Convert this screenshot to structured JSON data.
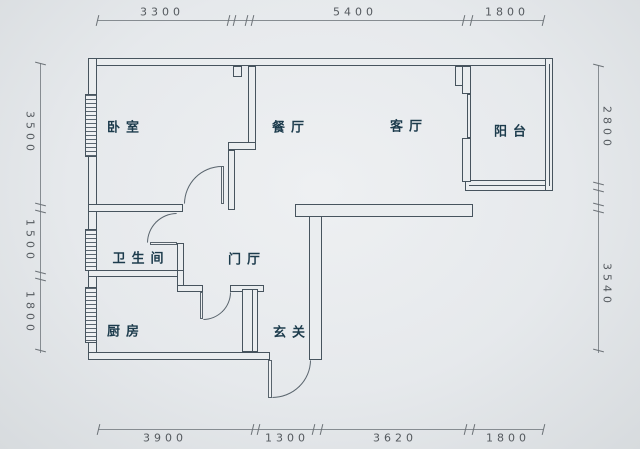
{
  "title": "apartment-floor-plan",
  "rooms": {
    "bedroom": {
      "label": "卧室"
    },
    "dining": {
      "label": "餐厅"
    },
    "living": {
      "label": "客厅"
    },
    "balcony": {
      "label": "阳台"
    },
    "bathroom": {
      "label": "卫生间"
    },
    "hall": {
      "label": "门厅"
    },
    "kitchen": {
      "label": "厨房"
    },
    "entry": {
      "label": "玄关"
    }
  },
  "dims": {
    "top": [
      {
        "value": "3300"
      },
      {
        "value": "5400"
      },
      {
        "value": "1800"
      }
    ],
    "bottom": [
      {
        "value": "3900"
      },
      {
        "value": "1300"
      },
      {
        "value": "3620"
      },
      {
        "value": "1800"
      }
    ],
    "left": [
      {
        "value": "3500"
      },
      {
        "value": "1500"
      },
      {
        "value": "1800"
      }
    ],
    "right": [
      {
        "value": "2800"
      },
      {
        "value": "3540"
      }
    ]
  },
  "colors": {
    "wall": "#47545e",
    "room_text": "#1c3b4c",
    "dimension_line": "#868c91",
    "dimension_text": "#54595e",
    "background": "#e6e9ec"
  }
}
